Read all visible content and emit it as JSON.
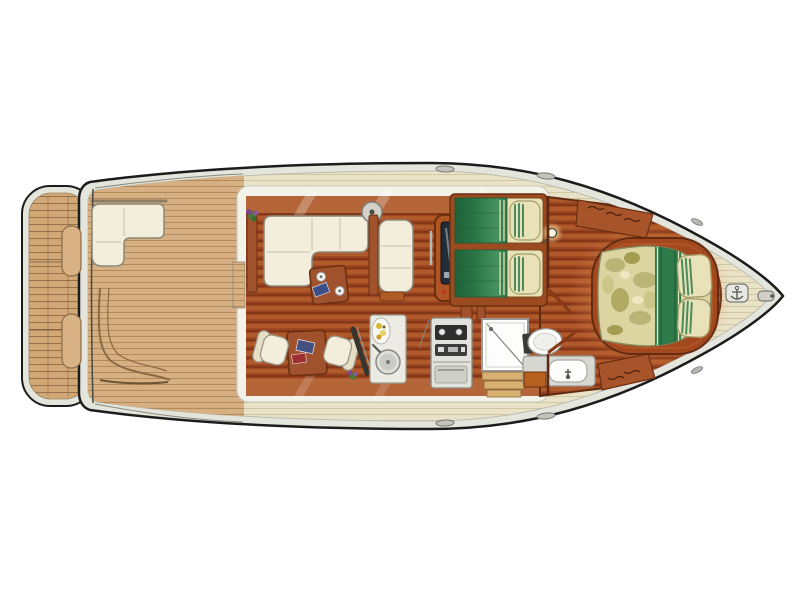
{
  "canvas": {
    "width": 800,
    "height": 600,
    "background": "#ffffff"
  },
  "diagram": {
    "type": "boat-floor-plan",
    "description": "Top-down interior and deck plan of a motor yacht, bow pointing right, stern swim platform at left",
    "orientation": {
      "bow": "right",
      "stern": "left"
    }
  },
  "colors": {
    "background": "#ffffff",
    "hull_outline": "#1c1c1c",
    "hull_rim": "#e4e5dc",
    "deck_teak": "#d6b083",
    "deck_plank_line": "#a8814f",
    "bow_deck": "#eae2c6",
    "bow_plank_line": "#cfc49e",
    "salon_floor": "#9c4520",
    "floor_stripe": "#6b2a10",
    "floor_highlight": "#b05a2a",
    "cabin_wall": "#f3f2e8",
    "upholstery_cream": "#f2eedb",
    "upholstery_border": "#8a8878",
    "wood_trim": "#a0522d",
    "wood_dark": "#6b2f10",
    "copper": "#b5673a",
    "bedding_green": "#2e7a48",
    "bedding_cream": "#e9e2b8",
    "fixture_white": "#fdfdfb",
    "appliance_gray": "#d8d8d2",
    "helm_screen": "#222b38",
    "lamp_glow": "#ffe9a0",
    "platform_teak": "#d2a876",
    "platform_line": "#8a6440"
  },
  "areas": [
    {
      "id": "swim-platform",
      "label": "Teak swim platform with boarding step pads"
    },
    {
      "id": "aft-deck",
      "label": "Aft cockpit deck with L-shaped seat and corner bench"
    },
    {
      "id": "salon",
      "label": "Salon with L-sofa, chaise bench, coffee table, dinette and wet bar"
    },
    {
      "id": "helm-station",
      "label": "Inside helm console with navigation screen"
    },
    {
      "id": "guest-cabin",
      "label": "Guest cabin with two single berths and wall lamp"
    },
    {
      "id": "galley",
      "label": "Galley stove unit"
    },
    {
      "id": "bathroom",
      "label": "Head with shower, toilet and vanity sink"
    },
    {
      "id": "corridor",
      "label": "Companionway corridor with cabin doors and lockers"
    },
    {
      "id": "master-cabin",
      "label": "Forward master cabin with island double bed"
    },
    {
      "id": "bow-deck",
      "label": "Foredeck with cleats and anchor windlass"
    }
  ],
  "fixtures": [
    "l-sofa",
    "chaise-bench",
    "coffee-table",
    "dinette-table",
    "dinette-chair",
    "wet-bar-sink",
    "fruit-dish",
    "helm-screen",
    "single-berth",
    "pillow",
    "wall-lamp",
    "stove",
    "shower-tray",
    "companionway-steps",
    "toilet",
    "vanity-basin",
    "cabin-door",
    "locker-hatch",
    "master-bed",
    "anchor-windlass",
    "deck-cleat",
    "swim-step-pad",
    "plant"
  ]
}
